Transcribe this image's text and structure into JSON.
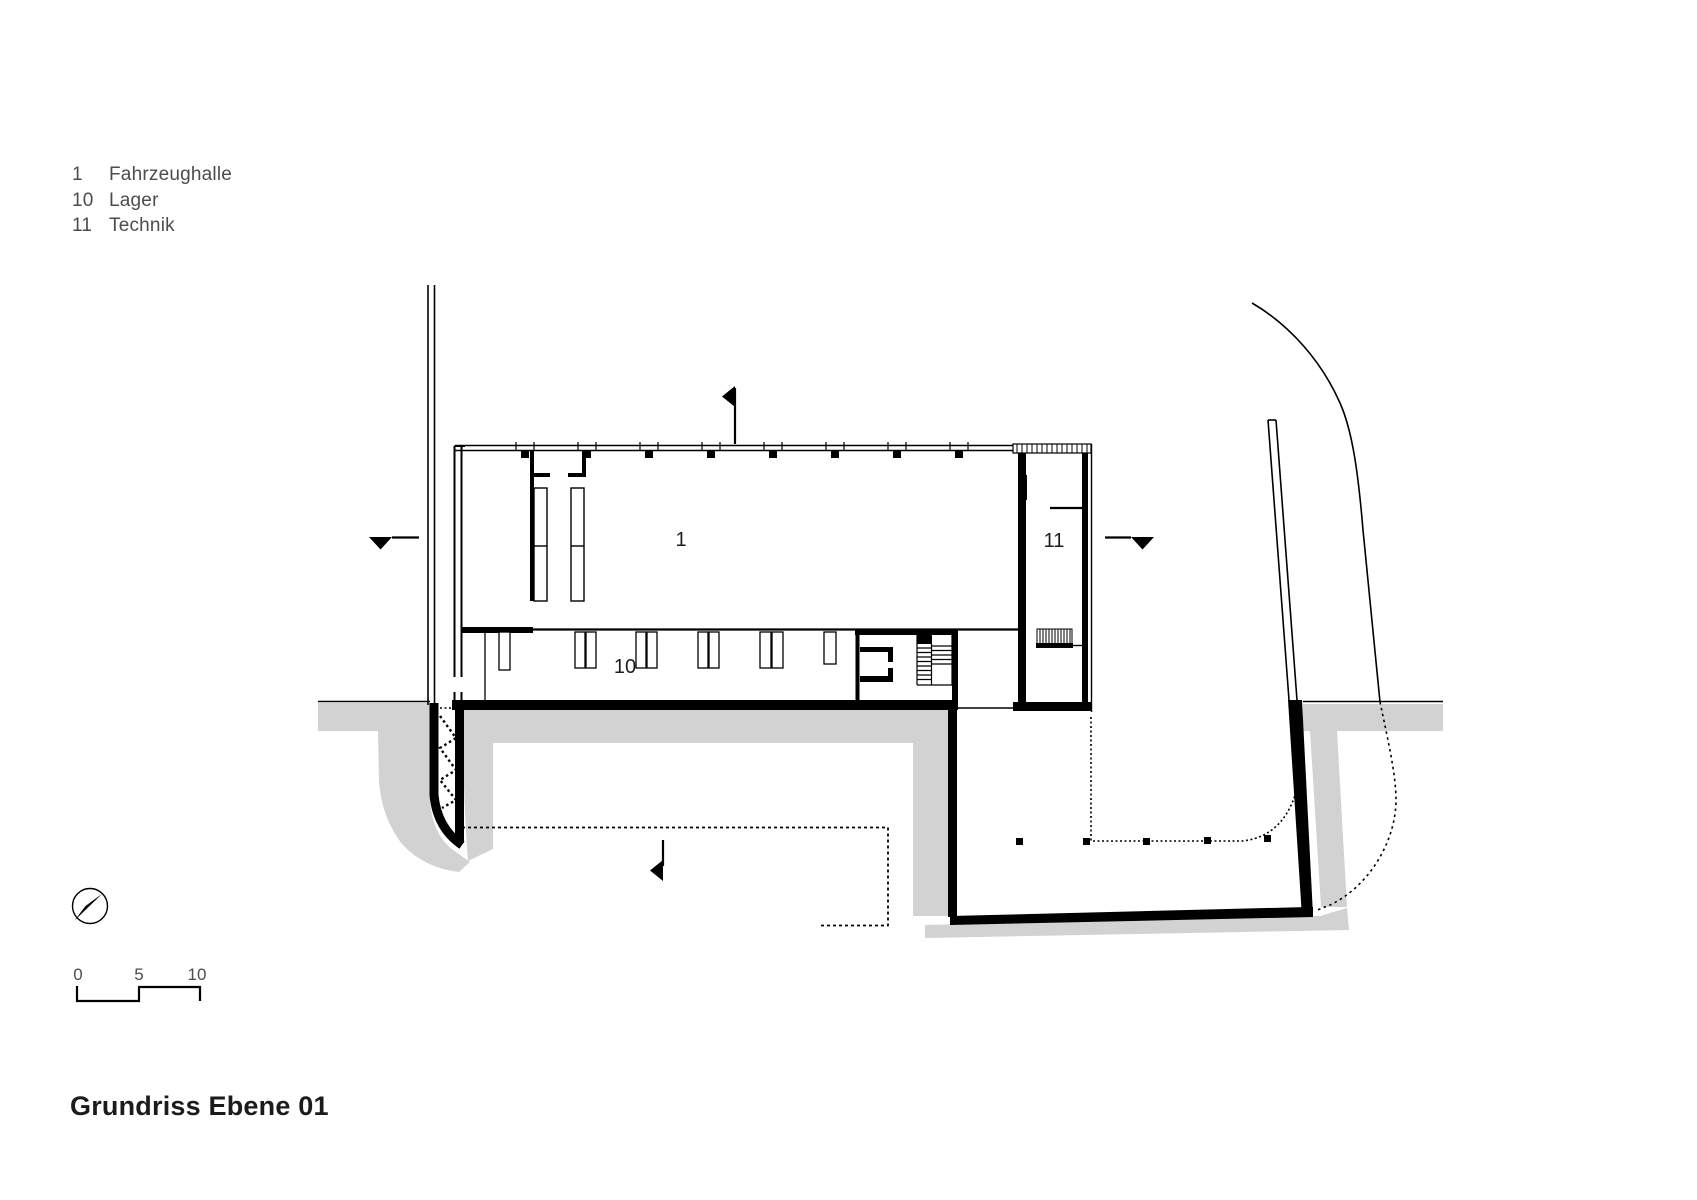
{
  "title_block": {
    "text": "Grundriss Ebene 01"
  },
  "legend": {
    "items": [
      {
        "number": "1",
        "label": "Fahrzeughalle"
      },
      {
        "number": "10",
        "label": "Lager"
      },
      {
        "number": "11",
        "label": "Technik"
      }
    ]
  },
  "plan": {
    "drawing_type": "floor-plan",
    "level": "Ebene 01",
    "rooms": [
      {
        "number": "1",
        "name": "Fahrzeughalle"
      },
      {
        "number": "10",
        "name": "Lager"
      },
      {
        "number": "11",
        "name": "Technik"
      }
    ]
  },
  "scale_bar": {
    "ticks": [
      "0",
      "5",
      "10"
    ]
  },
  "colors": {
    "line": "#000000",
    "terrain_gray": "#d2d2d2",
    "label_text": "#1e1e1e",
    "annotation_text": "#4c4c4c",
    "background": "#ffffff"
  }
}
